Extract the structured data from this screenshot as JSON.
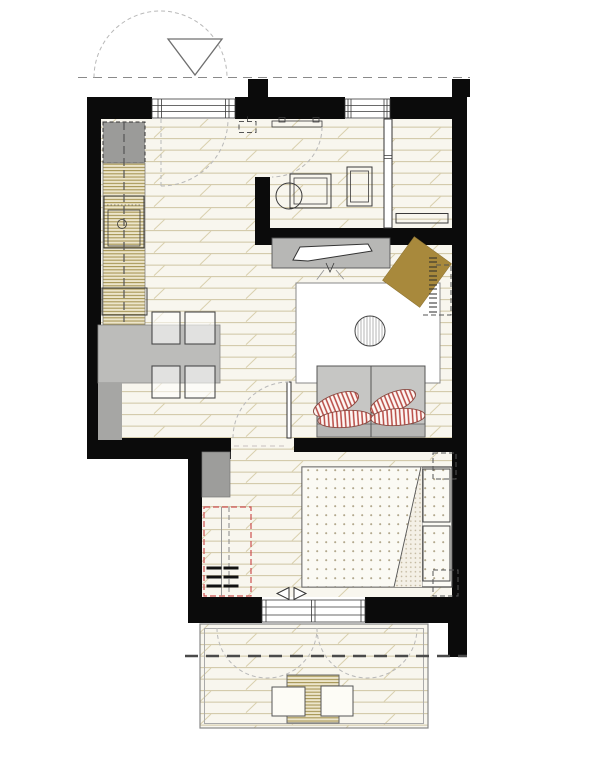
{
  "meta": {
    "title": "Apartment floor plan - top view architectural drawing",
    "canvas_width": 614,
    "canvas_height": 768
  },
  "palette": {
    "wall": "#0b0b0b",
    "floor_bg": "#f8f6ee",
    "floor_line": "#cfc5a3",
    "floor_line2": "#d9d0ae",
    "counter_bg": "#ece5cb",
    "counter_line": "#a79655",
    "appliance": "#9b9b99",
    "furn": "#bcbcba",
    "sofa": "#c6c6c4",
    "bench": "#a6a6a4",
    "armchair": "#a8893c",
    "pillow_red": "#b84a44",
    "wardrobe_red": "#cc4f4f",
    "ink": "#3a3a3a",
    "mid": "#777777",
    "dash": "#b9b9b9",
    "dots": "#b3a98e",
    "dots_dense": "#bfb49a"
  },
  "legend": {
    "rooms": [
      {
        "id": "entry-kitchen",
        "label": "Entry / kitchen-dining"
      },
      {
        "id": "bathroom",
        "label": "Bathroom"
      },
      {
        "id": "storage-nook",
        "label": "Storage niche"
      },
      {
        "id": "living",
        "label": "Living area"
      },
      {
        "id": "bedroom",
        "label": "Bedroom"
      },
      {
        "id": "balcony",
        "label": "Balcony terrace"
      }
    ],
    "fixtures": [
      "entrance-arrow",
      "entrance-door-swing",
      "property-dashed-line",
      "refrigerator",
      "kitchen-counter",
      "sink",
      "cooktop",
      "dining-table",
      "dining-chair",
      "bench",
      "tv-sideboard",
      "tv",
      "rug",
      "pouf",
      "armchair",
      "throw-fringe",
      "sofa",
      "striped-cushion",
      "washbasin",
      "washing-machine",
      "bathroom-door",
      "partition-wall",
      "radiator-shelf",
      "interior-door",
      "wardrobe-dashed-outline",
      "drawer-unit",
      "cabinet",
      "double-bed",
      "duvet-fold",
      "pillow",
      "nightstand-dashed",
      "sliding-door-arrows",
      "balcony-window",
      "deck-swing-arcs",
      "balcony-table",
      "balcony-chair",
      "section-dashed-line"
    ]
  }
}
